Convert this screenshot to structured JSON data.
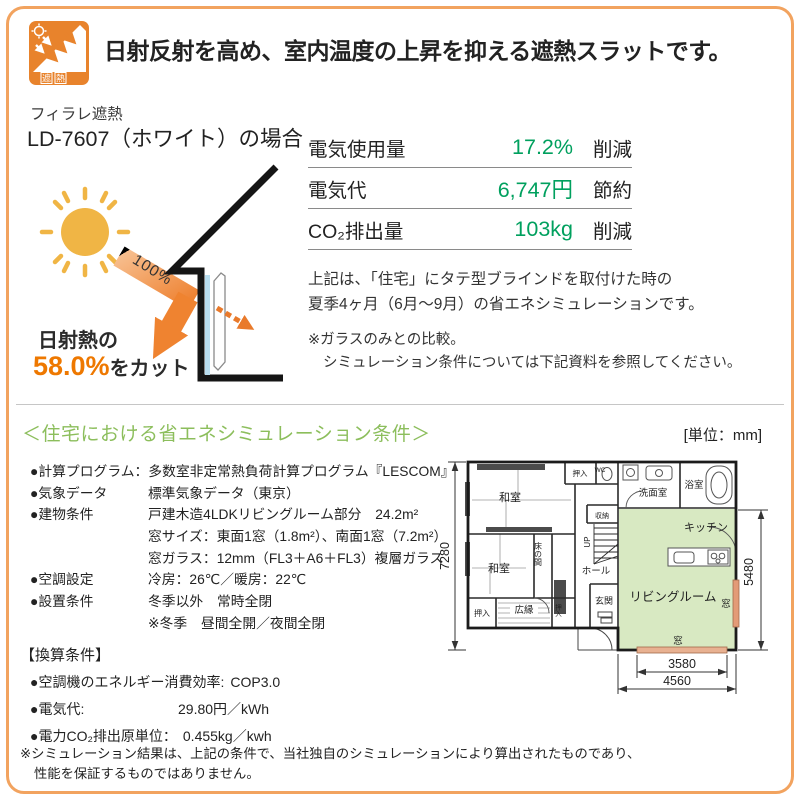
{
  "colors": {
    "frame_orange": "#F2A35F",
    "accent_orange": "#EE7800",
    "value_green": "#00A05E",
    "heading_green": "#8CBE5C",
    "plan_room_green": "#D8E9C2",
    "plan_window_orange": "#E39B77"
  },
  "header": {
    "icon_nf": "NF",
    "icon_sha": "遮",
    "icon_netsu": "熱",
    "title": "日射反射を高め、室内温度の上昇を抑える遮熱スラットです。"
  },
  "product": {
    "series": "フィラレ遮熱",
    "model_case": "LD-7607（ホワイト）の場合"
  },
  "illustration": {
    "incident_label": "100%",
    "cut_prefix": "日射熱の",
    "cut_value": "58.0%",
    "cut_suffix": "をカット"
  },
  "savings_table": {
    "rows": [
      {
        "label": "電気使用量",
        "value": "17.2%",
        "unit": "削減"
      },
      {
        "label": "電気代",
        "value": "6,747円",
        "unit": "節約"
      },
      {
        "label": "CO₂排出量",
        "value": "103kg",
        "unit": "削減"
      }
    ]
  },
  "summary": {
    "line1": "上記は、「住宅」にタテ型ブラインドを取付けた時の",
    "line2": "夏季4ヶ月（6月～9月）の省エネシミュレーションです。",
    "note1": "※ガラスのみとの比較。",
    "note2": "シミュレーション条件については下記資料を参照してください。"
  },
  "conditions": {
    "heading": "＜住宅における省エネシミュレーション条件＞",
    "rows": [
      {
        "label": "●計算プログラム：",
        "text": "多数室非定常熱負荷計算プログラム『LESCOM』"
      },
      {
        "label": "●気象データ",
        "text": "標準気象データ（東京）"
      },
      {
        "label": "●建物条件",
        "text": "戸建木造4LDKリビングルーム部分　24.2m²"
      },
      {
        "label": "",
        "text": "窓サイズ：東面1窓（1.8m²）、南面1窓（7.2m²）"
      },
      {
        "label": "",
        "text": "窓ガラス：12mm（FL3＋A6＋FL3）複層ガラス"
      },
      {
        "label": "●空調設定",
        "text": "冷房：26℃／暖房：22℃"
      },
      {
        "label": "●設置条件",
        "text": "冬季以外　常時全閉"
      },
      {
        "label": "",
        "text": "※冬季　昼間全開／夜間全閉"
      }
    ]
  },
  "conversion": {
    "heading": "【換算条件】",
    "rows": [
      {
        "label": "●空調機のエネルギー消費効率:",
        "value": "COP3.0"
      },
      {
        "label": "●電気代:",
        "value": "29.80円／kWh"
      },
      {
        "label": "●電力CO₂排出原単位：",
        "value": "0.455kg／kwh"
      }
    ]
  },
  "disclaimer": {
    "line1": "※シミュレーション結果は、上記の条件で、当社独自のシミュレーションにより算出されたものであり、",
    "line2": "性能を保証するものではありません。"
  },
  "floorplan": {
    "unit_note": "[単位：mm]",
    "rooms": {
      "washitsu_top": "和室",
      "washitsu_mid": "和室",
      "tokonoma": "床の間",
      "hiroen": "広縁",
      "oshiire_left": "押入",
      "oshiire_small": "押入",
      "oshiire_top": "押入",
      "wc": "WC",
      "senmen": "洗面室",
      "bath": "浴室",
      "closet": "収納",
      "up": "UP",
      "hall": "ホール",
      "genkan": "玄関",
      "kitchen": "キッチン",
      "living": "リビングルーム",
      "window_right": "窓",
      "window_bottom": "窓"
    },
    "dimensions": {
      "height_total": "7280",
      "height_living": "5480",
      "width_window": "3580",
      "width_living": "4560"
    }
  }
}
